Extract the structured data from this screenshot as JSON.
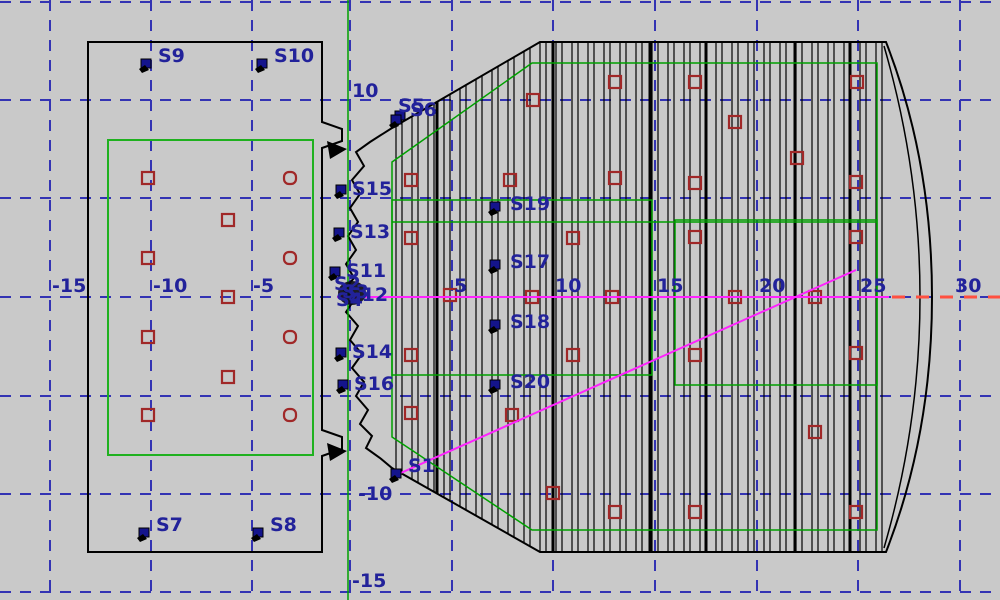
{
  "canvas": {
    "width": 1000,
    "height": 600,
    "bg": "#c9c9c9"
  },
  "colors": {
    "grid_blue": "#3333b3",
    "label_navy": "#22229a",
    "marker_red": "#a02828",
    "green": "#00a000",
    "green_left": "#1fb11f",
    "magenta": "#ff22ff",
    "axis_red_dash": "#ff5040",
    "structure_black": "#000000",
    "sensor_fill": "#14148c"
  },
  "grid": {
    "v_lines": [
      50,
      151,
      252,
      350,
      452,
      553,
      655,
      757,
      858,
      960
    ],
    "h_lines": [
      2,
      100,
      198,
      297,
      396,
      494,
      592
    ],
    "x_axis_y": 297,
    "x_tick_labels": [
      {
        "text": "-15",
        "x": 52,
        "y": 292
      },
      {
        "text": "-10",
        "x": 153,
        "y": 292
      },
      {
        "text": "-5",
        "x": 253,
        "y": 292
      },
      {
        "text": "5",
        "x": 454,
        "y": 292
      },
      {
        "text": "10",
        "x": 555,
        "y": 292
      },
      {
        "text": "15",
        "x": 657,
        "y": 292
      },
      {
        "text": "20",
        "x": 759,
        "y": 292
      },
      {
        "text": "25",
        "x": 860,
        "y": 292
      },
      {
        "text": "30",
        "x": 955,
        "y": 292
      }
    ],
    "y_tick_labels": [
      {
        "text": "10",
        "x": 352,
        "y": 97
      },
      {
        "text": "-10",
        "x": 358,
        "y": 500
      },
      {
        "text": "-15",
        "x": 352,
        "y": 587
      }
    ]
  },
  "shapes": {
    "left_outline": "M88,42 L322,42 L322,122 L342,129 L342,141 L322,148 L322,430 L342,437 L342,449 L322,456 L322,552 L88,552 Z",
    "left_green_rect": {
      "x": 108,
      "y": 140,
      "w": 205,
      "h": 315
    },
    "notch_triangles": [
      "M327,141 L347,149 L330,159 Z",
      "M327,443 L347,451 L330,461 Z"
    ],
    "right_outline": "M392,128 L540,42 L886,42 Q932,160 932,297 Q932,434 886,552 L540,552 L392,468 L380,458 L366,448 L372,436 L360,424 L368,410 L356,396 L364,382 L352,368 L362,354 L350,340 L358,326 L346,312 L354,300 L344,290 L354,278 L346,264 L356,250 L348,236 L358,222 L350,208 L360,194 L352,180 L364,166 L356,152 L370,142 Z",
    "inner_cap": "M884,46 Q920,170 920,297 Q920,424 884,548",
    "ribs": {
      "x_start": 396,
      "x_end": 882,
      "pair_step": 16,
      "pair_offset": 6,
      "thick": [
        437,
        553,
        650,
        706,
        795,
        850
      ]
    },
    "green_full_vline_x": 348,
    "green_contour": "M392,162 L532,63 L877,63 L877,530 L532,530 L392,437 Z",
    "green_rect_a": {
      "x": 392,
      "y": 200,
      "w": 260,
      "h": 175
    },
    "green_rect_b": {
      "x": 675,
      "y": 220,
      "w": 202,
      "h": 165
    },
    "green_extra_hline": {
      "x1": 392,
      "x2": 877,
      "y": 222
    }
  },
  "magenta_lines": [
    {
      "x1": 337,
      "y1": 297,
      "x2": 889,
      "y2": 297
    },
    {
      "x1": 394,
      "y1": 476,
      "x2": 856,
      "y2": 270
    }
  ],
  "axis_red_extension": {
    "x1": 892,
    "x2": 1002,
    "y": 297
  },
  "markers_left": {
    "squares": [
      [
        148,
        178
      ],
      [
        228,
        220
      ],
      [
        148,
        258
      ],
      [
        228,
        297
      ],
      [
        148,
        337
      ],
      [
        228,
        377
      ],
      [
        148,
        415
      ]
    ],
    "rounded": [
      [
        290,
        178
      ],
      [
        290,
        258
      ],
      [
        290,
        337
      ],
      [
        290,
        415
      ]
    ]
  },
  "markers_right": [
    [
      411,
      180
    ],
    [
      411,
      238
    ],
    [
      411,
      355
    ],
    [
      411,
      413
    ],
    [
      450,
      295
    ],
    [
      510,
      180
    ],
    [
      512,
      415
    ],
    [
      533,
      100
    ],
    [
      532,
      297
    ],
    [
      553,
      493
    ],
    [
      573,
      238
    ],
    [
      573,
      355
    ],
    [
      612,
      297
    ],
    [
      615,
      82
    ],
    [
      615,
      178
    ],
    [
      615,
      512
    ],
    [
      695,
      82
    ],
    [
      695,
      183
    ],
    [
      695,
      237
    ],
    [
      695,
      355
    ],
    [
      695,
      512
    ],
    [
      735,
      122
    ],
    [
      735,
      297
    ],
    [
      797,
      158
    ],
    [
      815,
      297
    ],
    [
      815,
      432
    ],
    [
      857,
      82
    ],
    [
      856,
      182
    ],
    [
      856,
      237
    ],
    [
      856,
      353
    ],
    [
      856,
      512
    ]
  ],
  "sensors": [
    {
      "label": "S9",
      "tx": 158,
      "ty": 62,
      "mx": 146,
      "my": 60
    },
    {
      "label": "S10",
      "tx": 274,
      "ty": 62,
      "mx": 262,
      "my": 60
    },
    {
      "label": "S7",
      "tx": 156,
      "ty": 531,
      "mx": 144,
      "my": 529
    },
    {
      "label": "S8",
      "tx": 270,
      "ty": 531,
      "mx": 258,
      "my": 529
    },
    {
      "label": "S5",
      "tx": 398,
      "ty": 112,
      "mx": 400,
      "my": 112
    },
    {
      "label": "S6",
      "tx": 410,
      "ty": 116,
      "mx": 396,
      "my": 116
    },
    {
      "label": "S15",
      "tx": 352,
      "ty": 195,
      "mx": 341,
      "my": 186
    },
    {
      "label": "S13",
      "tx": 350,
      "ty": 238,
      "mx": 339,
      "my": 229
    },
    {
      "label": "S11",
      "tx": 346,
      "ty": 277,
      "mx": 335,
      "my": 268
    },
    {
      "label": "S14",
      "tx": 352,
      "ty": 358,
      "mx": 341,
      "my": 349
    },
    {
      "label": "S16",
      "tx": 354,
      "ty": 390,
      "mx": 343,
      "my": 381
    },
    {
      "label": "S19",
      "tx": 510,
      "ty": 210,
      "mx": 495,
      "my": 203
    },
    {
      "label": "S17",
      "tx": 510,
      "ty": 268,
      "mx": 495,
      "my": 261
    },
    {
      "label": "S18",
      "tx": 510,
      "ty": 328,
      "mx": 495,
      "my": 321
    },
    {
      "label": "S20",
      "tx": 510,
      "ty": 388,
      "mx": 495,
      "my": 381
    },
    {
      "label": "S1",
      "tx": 408,
      "ty": 472,
      "mx": 396,
      "my": 470
    },
    {
      "label": "S2",
      "tx": 334,
      "ty": 290,
      "mx": null,
      "my": null
    },
    {
      "label": "S3",
      "tx": 342,
      "ty": 298,
      "mx": null,
      "my": null
    },
    {
      "label": "S4",
      "tx": 336,
      "ty": 306,
      "mx": null,
      "my": null
    },
    {
      "label": "S12",
      "tx": 348,
      "ty": 301,
      "mx": null,
      "my": null
    }
  ],
  "origin_blob": {
    "cx": 352,
    "cy": 293,
    "rx": 14,
    "ry": 12
  }
}
